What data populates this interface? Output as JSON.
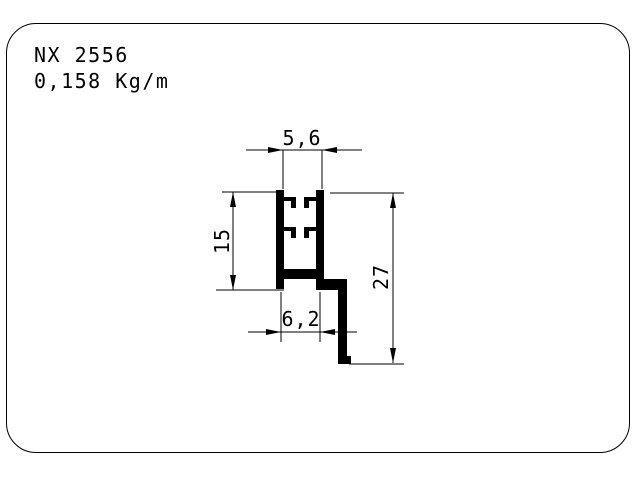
{
  "drawing": {
    "title": {
      "code": "NX 2556",
      "weight": "0,158 Kg/m"
    },
    "dimensions": {
      "top_width": "5,6",
      "left_height": "15",
      "bottom_width": "6,2",
      "right_height": "27"
    },
    "colors": {
      "ink": "#000000",
      "paper": "#ffffff"
    }
  }
}
